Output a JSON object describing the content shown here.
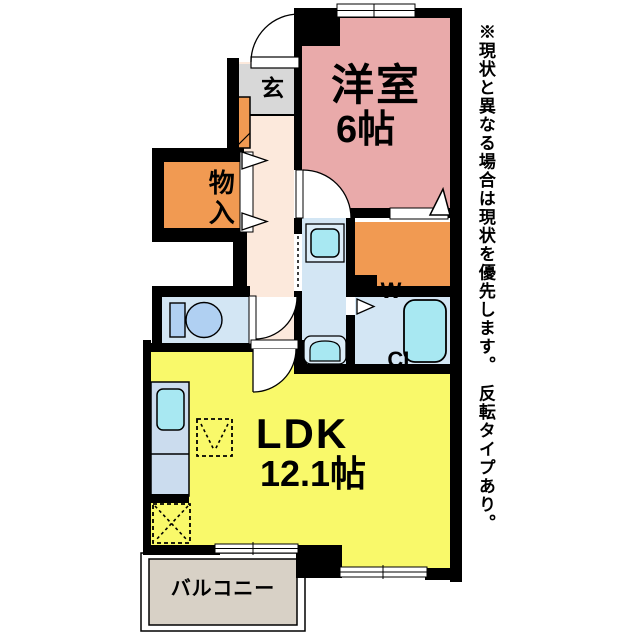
{
  "floorplan": {
    "rooms": {
      "western_room": {
        "name": "洋室",
        "size": "6帖"
      },
      "entrance": {
        "name": "玄"
      },
      "storage": {
        "name": "物入"
      },
      "walk_in_closet": {
        "name_line1": "W—",
        "name_line2": "CL"
      },
      "ldk": {
        "name": "LDK",
        "size": "12.1帖"
      },
      "balcony": {
        "name": "バルコニー"
      }
    },
    "note": "※現状と異なる場合は現状を優先します。　反転タイプあり。",
    "colors": {
      "western_room": "#e9aaaa",
      "entrance": "#d8d8d8",
      "hallway": "#fce9dc",
      "orange": "#f19a52",
      "wet_area": "#d3e6f4",
      "fixture_base": "#dcedf8",
      "fixture_cyan": "#a8e8f2",
      "toilet_fixture": "#b0d0f2",
      "kitchen_counter": "#cbdcee",
      "ldk": "#f9f96a",
      "balcony": "#d8d1c6",
      "wall": "#000000"
    }
  }
}
